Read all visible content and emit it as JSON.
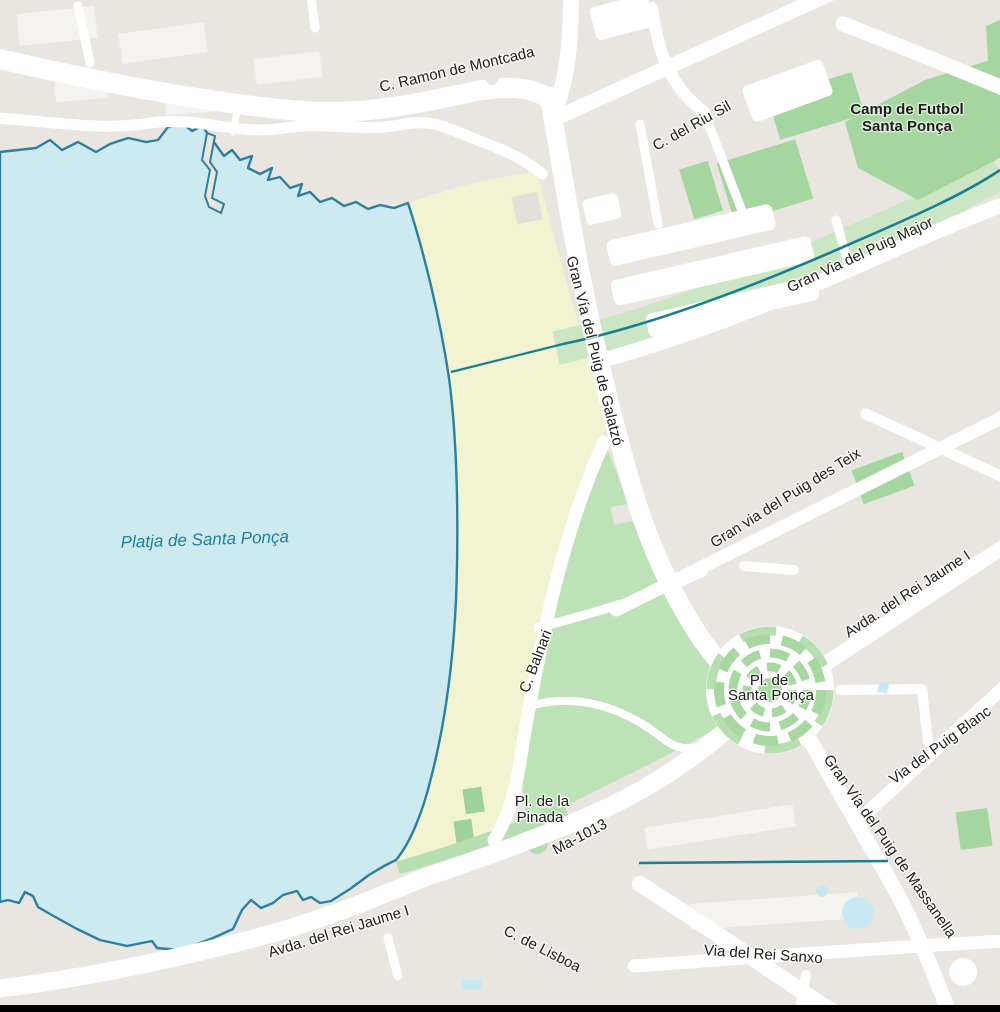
{
  "map": {
    "app": "map-view",
    "place": "Santa Ponça",
    "colors": {
      "land": "#e9e6e1",
      "road": "#ffffff",
      "water_fill": "#cdeaf1",
      "water_outline": "#2e7f9c",
      "beach_sand": "#f2f3d0",
      "park_green": "#bee2b7",
      "sports_field_green": "#a6d6a0",
      "stream_strip_green": "#cbe6c4",
      "stream_line": "#1a7e92",
      "pond_blue": "#c7e9f4",
      "label_text": "#1e1e1c",
      "water_label_text": "#1f7f9d",
      "building": "#f5f3ef"
    },
    "labels": {
      "ramon_montcada": "C. Ramon de Montcada",
      "riu_sil": "C. del Riu Sil",
      "camp_futbol_line1": "Camp de Futbol",
      "camp_futbol_line2": "Santa Ponça",
      "puig_major": "Gran Via del Puig Major",
      "galatzo": "Gran Vía del Puig de Galatzó",
      "platja": "Platja de Santa Ponça",
      "des_teix": "Gran via del Puig des Teix",
      "jaume_right": "Avda. del Rei Jaume I",
      "balnari": "C. Balnari",
      "pl_santa_ponca_line1": "Pl. de",
      "pl_santa_ponca_line2": "Santa Ponça",
      "puig_blanc": "Via del Puig Blanc",
      "massanella": "Gran Vía del Puig de Massanella",
      "pinada_line1": "Pl. de la",
      "pinada_line2": "Pinada",
      "ma_1013": "Ma-1013",
      "jaume_bottom": "Avda. del Rei Jaume I",
      "lisboa": "C. de Lisboa",
      "rei_sanxo": "Via del Rei Sanxo"
    }
  }
}
